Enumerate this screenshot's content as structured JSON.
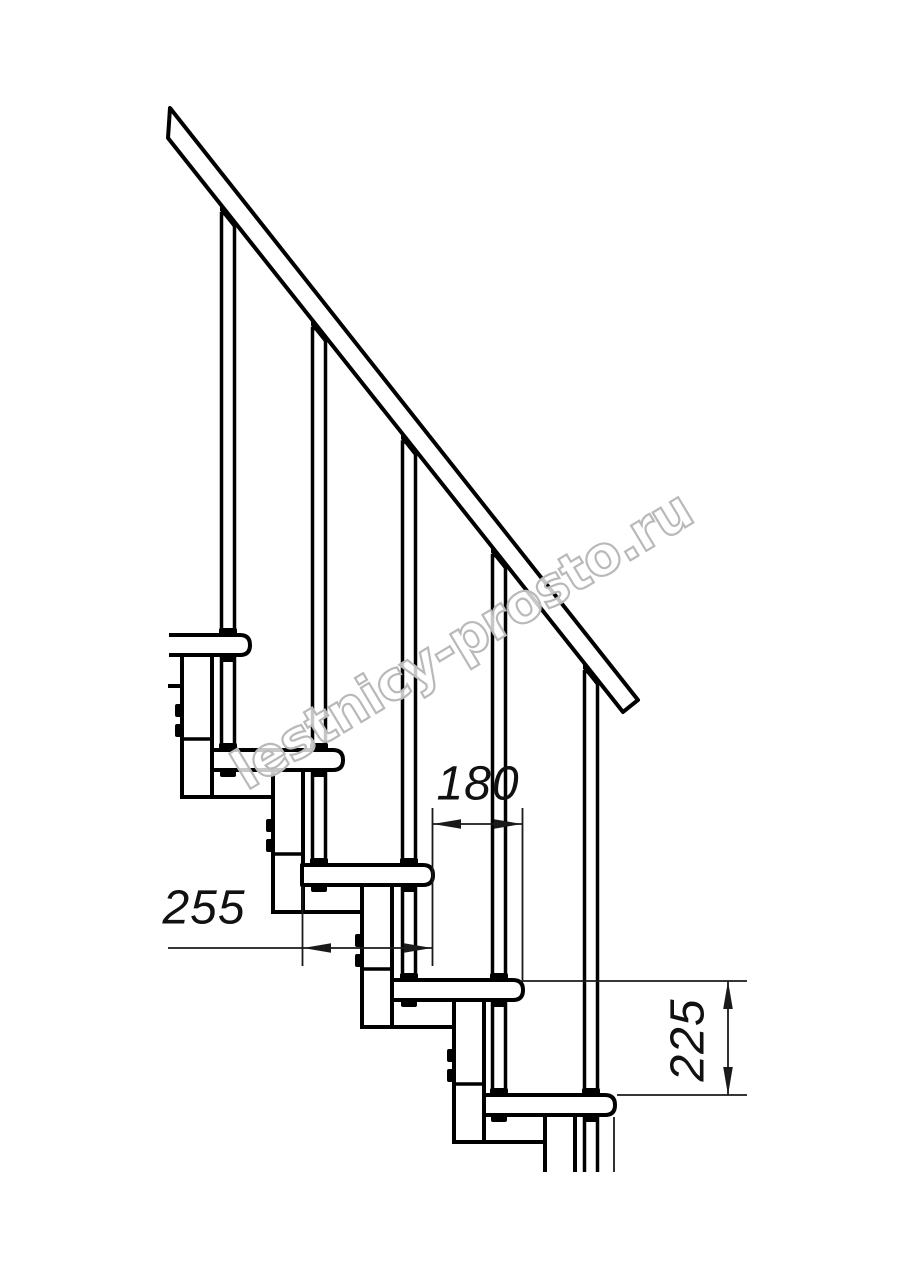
{
  "watermark": {
    "text": "lestnicy-prosto.ru"
  },
  "dimensions": {
    "step_run": "180",
    "tread_depth": "255",
    "riser_height": "225"
  },
  "colors": {
    "line": "#000000",
    "dim_line": "#1a1a1a",
    "watermark_outline": "#b9b9b9",
    "background": "#ffffff"
  }
}
